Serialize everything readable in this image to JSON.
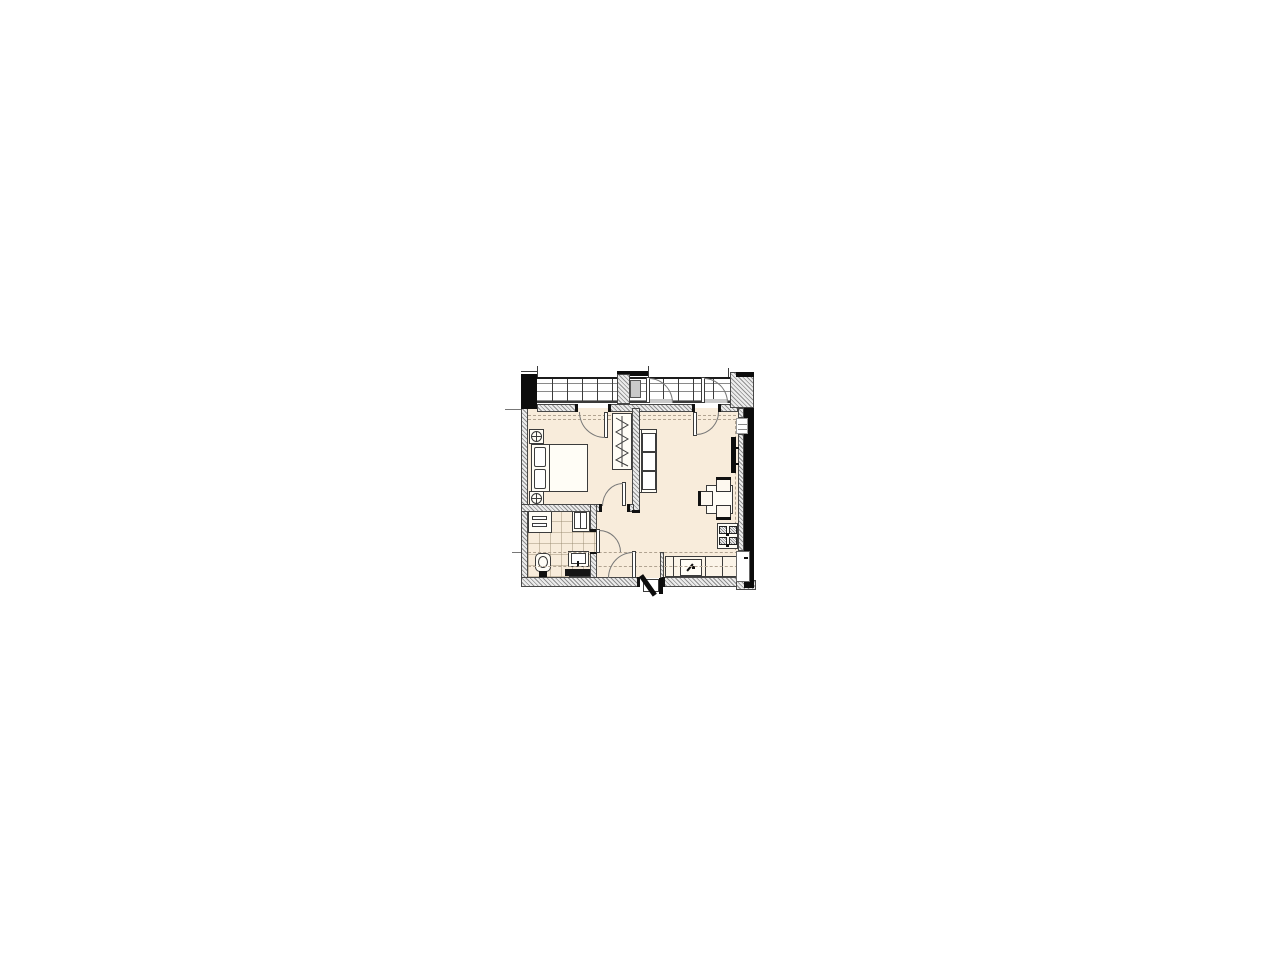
{
  "palette": {
    "background": "#ffffff",
    "floor": "#f8ecdb",
    "wall_fill": "#ececec",
    "wall_hatch_line": "#8f8f8f",
    "wall_outline": "#474747",
    "structure_black": "#0c0c0c",
    "dashed_line": "#b1a391",
    "glazing_line": "#8a8a8a",
    "panel_gray": "#c9c9c9",
    "furniture_line": "#3c3c3c",
    "counter_black": "#151515"
  },
  "plan": {
    "type": "apartment-floor-plan",
    "rooms": [
      "balcony-glazed-band",
      "bedroom",
      "living-room-with-kitchen",
      "bathroom",
      "hallway"
    ],
    "fixtures": [
      "double-bed",
      "nightstand-lamp",
      "wardrobe-hangers",
      "sofa-three-seat",
      "tv-wall-panel",
      "dining-table",
      "dining-chair",
      "cooktop-4-burner",
      "kitchen-counter",
      "kitchen-sink",
      "washing-machine",
      "shower-cabinet",
      "toilet",
      "vanity-sink",
      "entry-door",
      "interior-door",
      "balcony-door"
    ]
  }
}
